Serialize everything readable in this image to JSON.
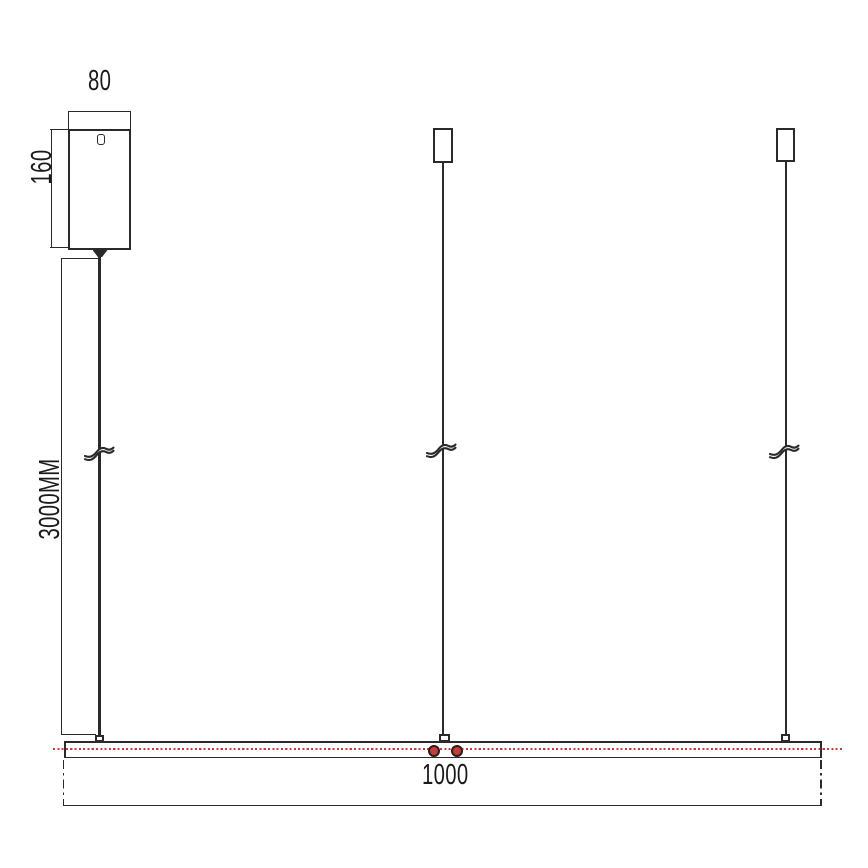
{
  "drawing": {
    "type": "pendant-light-installation-dimension-drawing",
    "dimensions": {
      "canopy_width": "80",
      "canopy_height": "160",
      "suspension_length": "3000MM",
      "fixture_length": "1000"
    },
    "icons": {
      "cable_break": "cable-break-icon (S-curve break symbol on each suspension wire)",
      "keyhole": "keyhole-icon (screw hole on canopy face)"
    },
    "colors": {
      "line": "#2a2a2a",
      "text": "#1a1a1a",
      "accent_red": "#c43c3c"
    }
  }
}
